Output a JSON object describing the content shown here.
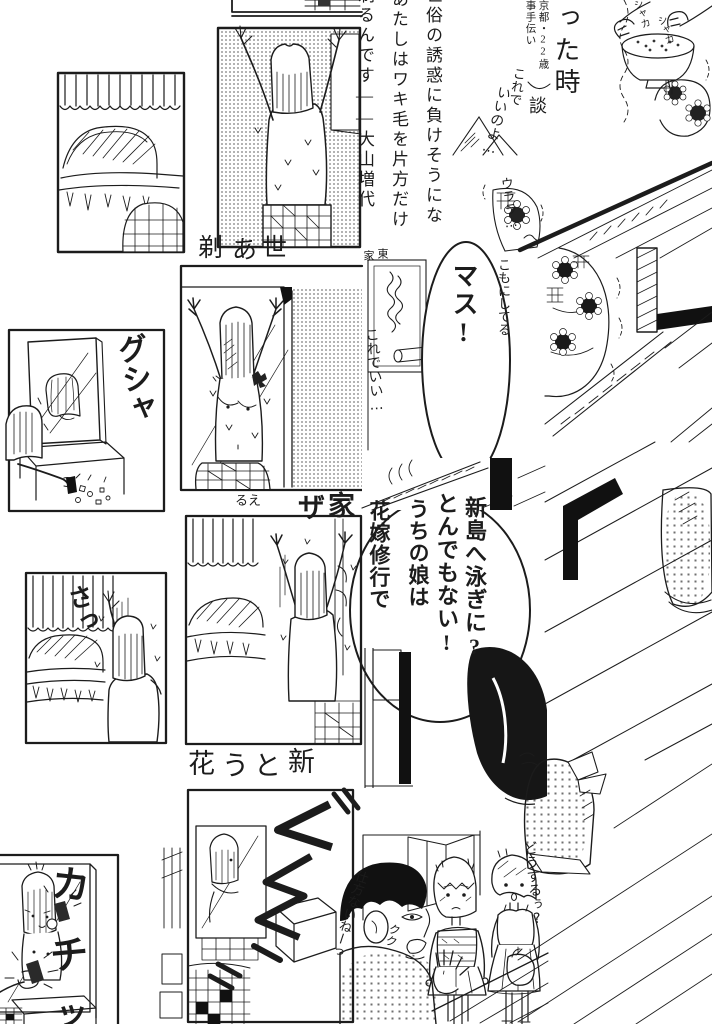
{
  "essay": {
    "col1": "世俗の誘惑に負けそうにな",
    "col2": "あたしはワキ毛を片方だけ",
    "col3": "剃るんです――大山増代",
    "continuation": "った時",
    "attr_line1": "京都・22歳",
    "attr_line2": "事手伝い",
    "attr_suffix": "談"
  },
  "speech": {
    "masu": "マス!",
    "line1": "新島へ泳ぎに?",
    "line2": "とんでもない!",
    "line3": "うちの娘は",
    "line4": "花嫁修行で"
  },
  "sfx": {
    "gusha": "グシャ",
    "sa": "さっ",
    "kachi_1": "カ",
    "kachi_2": "チ",
    "kachi_3": "ッ"
  },
  "handwriting": {
    "korede": "これで",
    "iinoyo": "いいのよ…",
    "urara": "ウララ…",
    "shaka_1": "シャカ",
    "shaka_2": "シャカ",
    "koredeii": "これでいい…",
    "komo": "こもにしてる",
    "rue": "るえ",
    "shikata": "仕方ないねーっ",
    "kuku": "クク",
    "dousuru": "どうするぅ?"
  },
  "fragments": {
    "r1c1": "剃",
    "r1c2": "あ",
    "r1c3": "世",
    "ie_small": "家",
    "higashi_small": "東",
    "za": "ザ",
    "ie_large": "家",
    "r3c1": "花",
    "r3c2": "う",
    "r3c3": "と",
    "r3c4": "新"
  },
  "colors": {
    "ink": "#1c1c1c",
    "paper": "#ffffff",
    "tone": "#8c8c8c"
  }
}
